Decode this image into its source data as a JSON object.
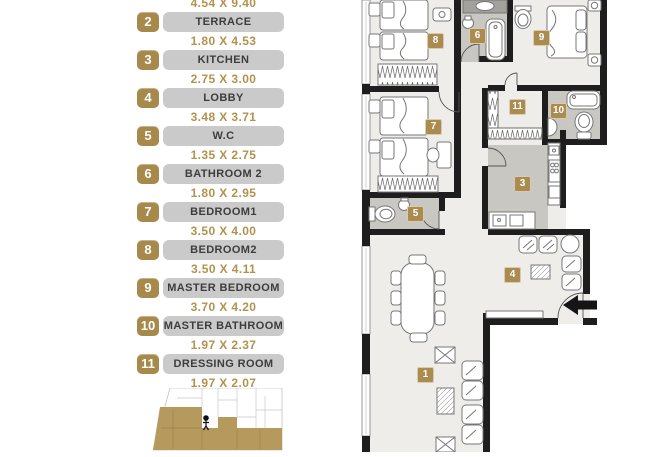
{
  "legend": {
    "top_partial_dimension": "4.54 X 9.40",
    "items": [
      {
        "number": "2",
        "label": "TERRACE",
        "dimension": "1.80 X 4.53"
      },
      {
        "number": "3",
        "label": "KITCHEN",
        "dimension": "2.75 X 3.00"
      },
      {
        "number": "4",
        "label": "LOBBY",
        "dimension": "3.48 X 3.71"
      },
      {
        "number": "5",
        "label": "W.C",
        "dimension": "1.35 X 2.75"
      },
      {
        "number": "6",
        "label": "BATHROOM 2",
        "dimension": "1.80 X 2.95"
      },
      {
        "number": "7",
        "label": "BEDROOM1",
        "dimension": "3.50 X 4.00"
      },
      {
        "number": "8",
        "label": "BEDROOM2",
        "dimension": "3.50 X 4.11"
      },
      {
        "number": "9",
        "label": "MASTER BEDROOM",
        "dimension": "3.70 X 4.20"
      },
      {
        "number": "10",
        "label": "MASTER BATHROOM",
        "dimension": "1.97 X 2.37"
      },
      {
        "number": "11",
        "label": "DRESSING ROOM",
        "dimension": "1.97 X 2.07"
      }
    ]
  },
  "plan": {
    "badges": {
      "b1": "1",
      "b3": "3",
      "b4": "4",
      "b5": "5",
      "b6": "6",
      "b7": "7",
      "b8": "8",
      "b9": "9",
      "b10": "10",
      "b11": "11"
    },
    "entry_arrow_icon": "left-arrow"
  },
  "minimap": {
    "person_marker_icon": "person-icon",
    "highlighted_unit_color": "#b6995d"
  },
  "colors": {
    "accent_gold": "#a8894c",
    "dimension_text": "#b2934e",
    "pill_gray": "#cacaca",
    "wall_black": "#1e1e1e",
    "floor_light": "#eeede9",
    "floor_wet_gray": "#c9c7c1",
    "vanity_gray": "#a3a19b"
  }
}
